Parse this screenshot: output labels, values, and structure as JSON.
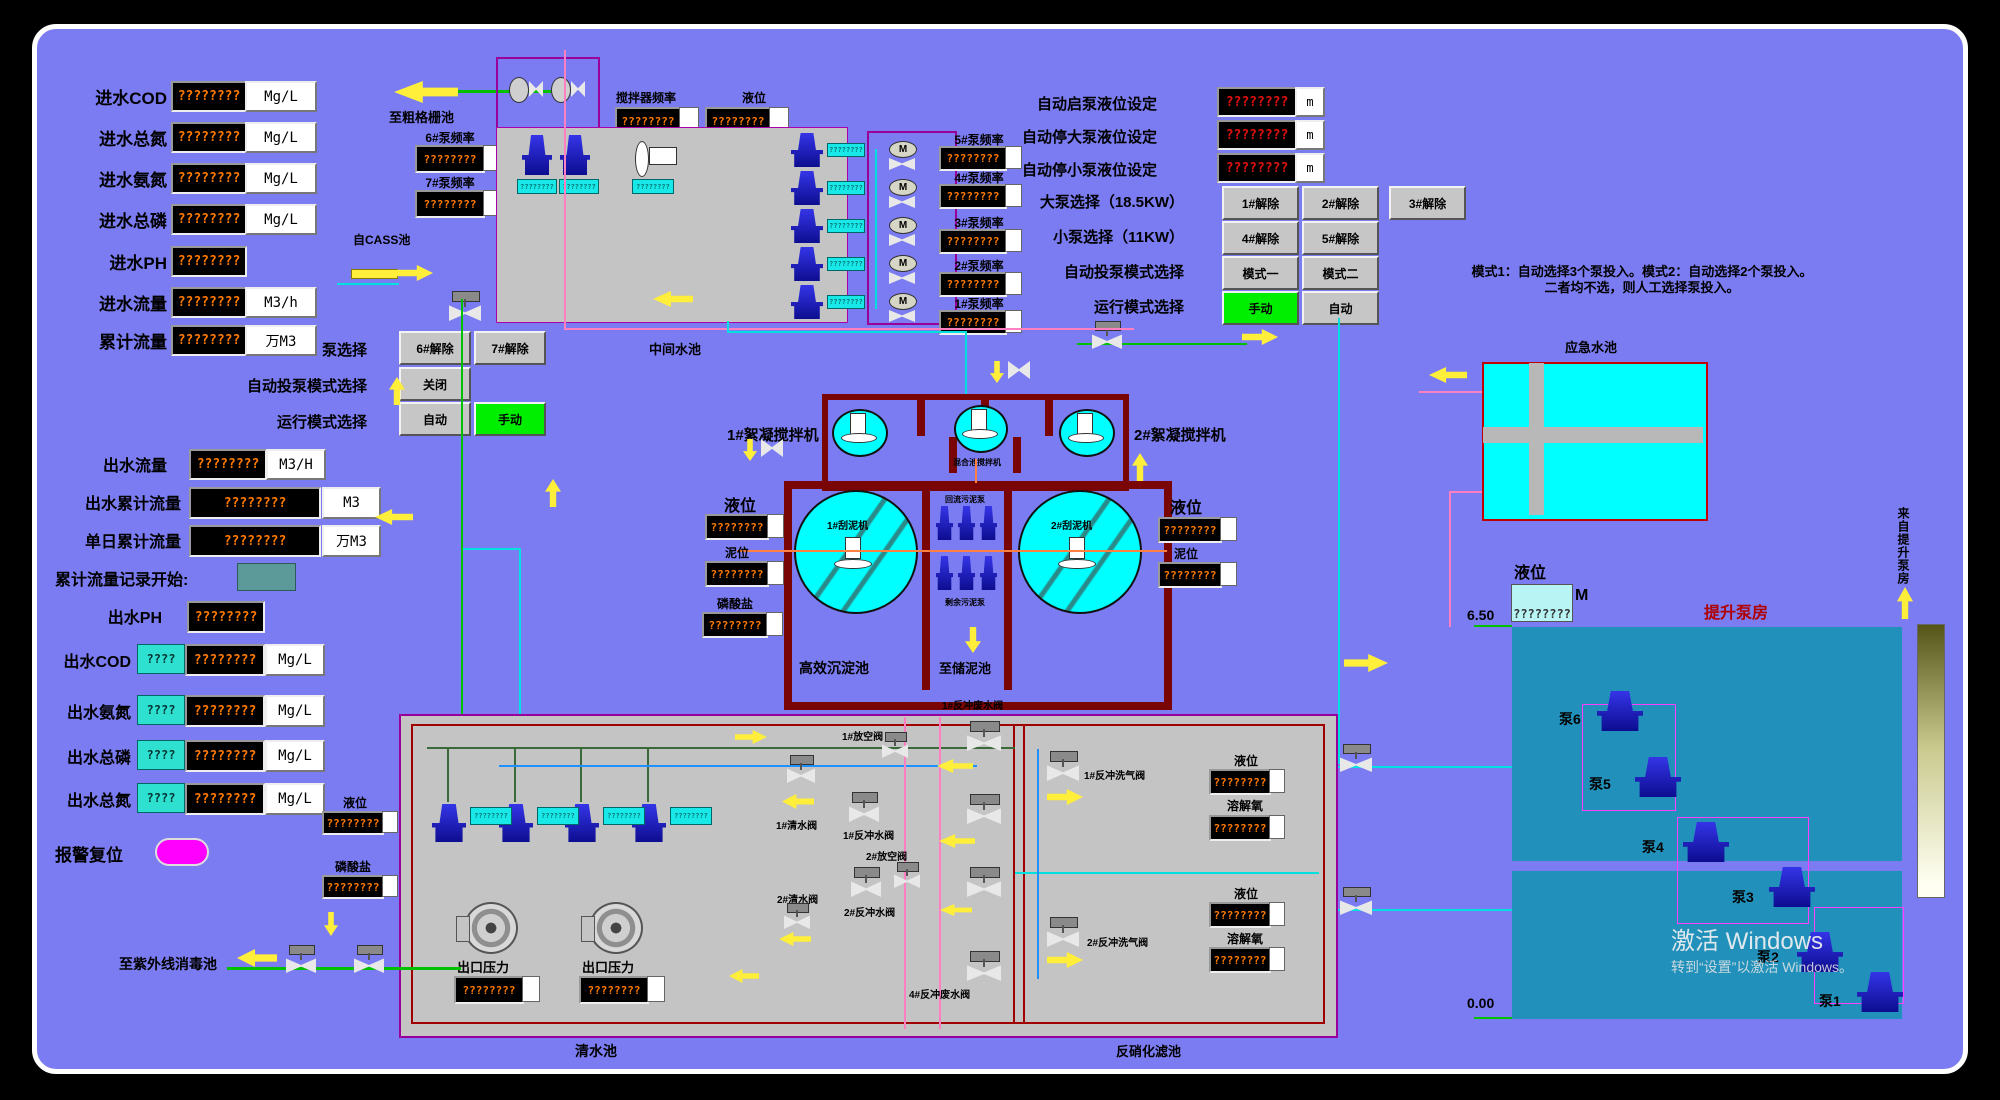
{
  "led": {
    "q8": "????????",
    "q4": "????"
  },
  "inlet": {
    "rows": [
      {
        "label": "进水COD",
        "unit": "Mg/L"
      },
      {
        "label": "进水总氮",
        "unit": "Mg/L"
      },
      {
        "label": "进水氨氮",
        "unit": "Mg/L"
      },
      {
        "label": "进水总磷",
        "unit": "Mg/L"
      },
      {
        "label": "进水PH",
        "unit": ""
      },
      {
        "label": "进水流量",
        "unit": "M3/h"
      },
      {
        "label": "累计流量",
        "unit": "万M3"
      }
    ]
  },
  "outlet": {
    "flow": {
      "label": "出水流量",
      "unit": "M3/H"
    },
    "total": {
      "label": "出水累计流量",
      "unit": "M3"
    },
    "daily": {
      "label": "单日累计流量",
      "unit": "万M3"
    },
    "record_label": "累计流量记录开始:",
    "ph_label": "出水PH",
    "quality": [
      {
        "label": "出水COD",
        "unit": "Mg/L"
      },
      {
        "label": "出水氨氮",
        "unit": "Mg/L"
      },
      {
        "label": "出水总磷",
        "unit": "Mg/L"
      },
      {
        "label": "出水总氮",
        "unit": "Mg/L"
      }
    ],
    "alarm_reset": "报警复位"
  },
  "pump_select": {
    "label": "泵选择",
    "btn6": "6#解除",
    "btn7": "7#解除",
    "mode_label": "自动投泵模式选择",
    "close_btn": "关闭",
    "run_label": "运行模式选择",
    "auto_btn": "自动",
    "manual_btn": "手动"
  },
  "top": {
    "to_coarse": "至粗格栅池",
    "from_cass": "自CASS池",
    "freq6": "6#泵频率",
    "freq7": "7#泵频率",
    "mixer_freq": "搅拌器频率",
    "level": "液位",
    "tank": "中间水池",
    "pump_freqs": [
      "5#泵频率",
      "4#泵频率",
      "3#泵频率",
      "2#泵频率",
      "1#泵频率"
    ],
    "motor": "M"
  },
  "settings": {
    "start_level": "自动启泵液位设定",
    "stop_big": "自动停大泵液位设定",
    "stop_small": "自动停小泵液位设定",
    "unit_m": "m",
    "big_label": "大泵选择（18.5KW）",
    "big_btns": [
      "1#解除",
      "2#解除",
      "3#解除"
    ],
    "small_label": "小泵选择（11KW）",
    "small_btns": [
      "4#解除",
      "5#解除"
    ],
    "mode_label": "自动投泵模式选择",
    "mode_btns": [
      "模式一",
      "模式二"
    ],
    "run_label": "运行模式选择",
    "run_manual": "手动",
    "run_auto": "自动",
    "note1": "模式1：自动选择3个泵投入。模式2：自动选择2个泵投入。",
    "note2": "二者均不选，则人工选择泵投入。"
  },
  "sed": {
    "mixer1": "1#絮凝搅拌机",
    "mixer2": "2#絮凝搅拌机",
    "center_mixer": "混合池搅拌机",
    "scraper1": "1#刮泥机",
    "scraper2": "2#刮泥机",
    "return_pumps": "回流污泥泵",
    "surplus_pumps": "剩余污泥泵",
    "name": "高效沉淀池",
    "to_sludge": "至储泥池",
    "level": "液位",
    "mud": "泥位",
    "phosphate": "磷酸盐"
  },
  "emergency": {
    "name": "应急水池",
    "level": "液位",
    "value": "????????",
    "unit": "M"
  },
  "lift": {
    "name": "提升泵房",
    "from": "来自提升泵房",
    "high": "6.50",
    "low": "0.00",
    "pumps": [
      "泵6",
      "泵5",
      "泵4",
      "泵3",
      "泵2",
      "泵1"
    ],
    "wm1": "激活 Windows",
    "wm2": "转到“设置”以激活 Windows。"
  },
  "cw": {
    "name": "清水池",
    "pressure": "出口压力",
    "uv": "至紫外线消毒池",
    "level": "液位",
    "phosphate": "磷酸盐"
  },
  "vg": {
    "v1": "1#反冲废水阀",
    "v2": "1#放空阀",
    "v3": "1#清水阀",
    "v4": "1#反冲水阀",
    "v5": "2#放空阀",
    "v6": "2#清水阀",
    "v7": "2#反冲水阀",
    "v8": "4#反冲废水阀"
  },
  "dn": {
    "name": "反硝化滤池",
    "g1": "1#反冲洗气阀",
    "g2": "2#反冲洗气阀",
    "level": "液位",
    "do": "溶解氧"
  }
}
